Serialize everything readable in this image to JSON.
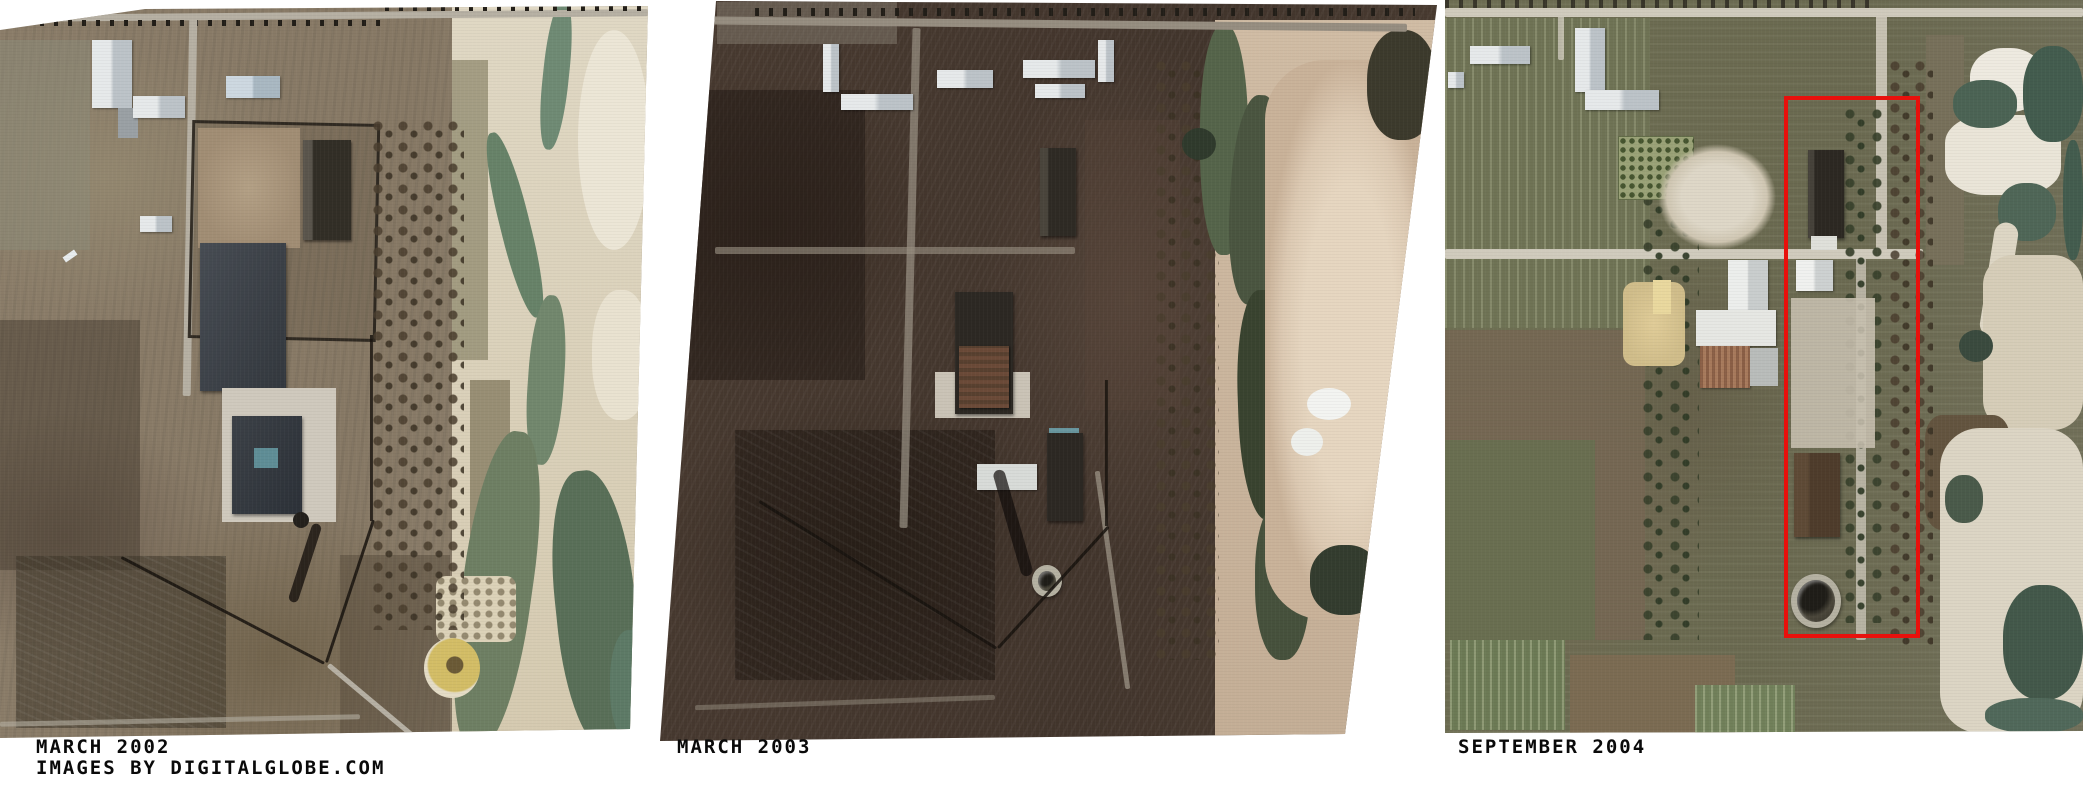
{
  "figure": {
    "type": "satellite-image-comparison-triptych",
    "background": "#ffffff",
    "caption_color": "#0a0a0a",
    "credit": "IMAGES BY DIGITALGLOBE.COM",
    "panels": [
      {
        "id": "march-2002",
        "caption": "MARCH 2002"
      },
      {
        "id": "march-2003",
        "caption": "MARCH 2003"
      },
      {
        "id": "september-2004",
        "caption": "SEPTEMBER 2004",
        "annotation": {
          "shape": "rectangle",
          "color": "#e8100c"
        }
      }
    ]
  }
}
